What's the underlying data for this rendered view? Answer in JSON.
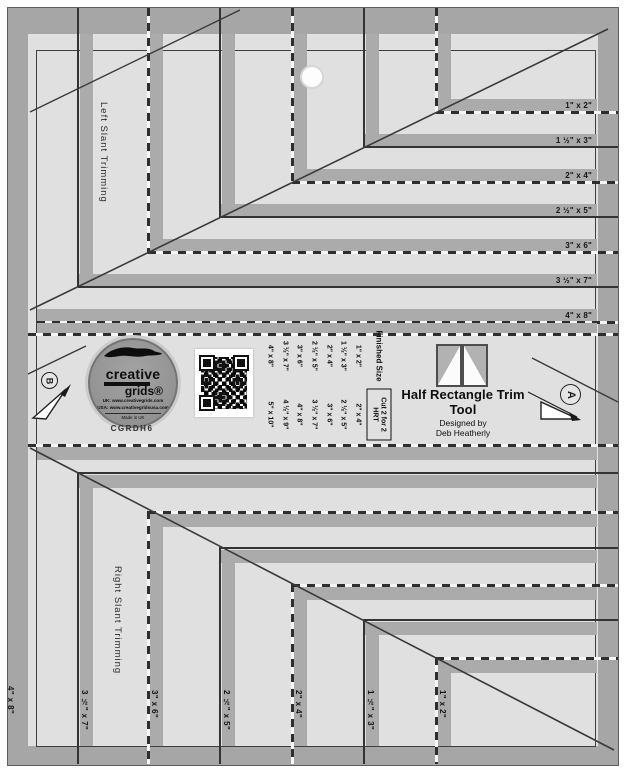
{
  "product": {
    "title": "Half Rectangle Trim Tool",
    "designed_by_label": "Designed by",
    "designer": "Deb Heatherly",
    "item_code": "CGRDH6"
  },
  "logo": {
    "brand_top": "creative",
    "brand_bottom": "grids®",
    "website_uk": "UK:  www.creativegrids.com",
    "website_usa": "USA:  www.creativegridsusa.com",
    "made_in": "Made in UK"
  },
  "markings": {
    "left_slant": "Left Slant Trimming",
    "right_slant": "Right Slant Trimming",
    "marker_a": "A",
    "marker_b": "B",
    "right_edge_sizes": [
      "1\" x 2\"",
      "1 ½\" x 3\"",
      "2\" x 4\"",
      "2 ½\" x 5\"",
      "3\" x 6\"",
      "3 ½\" x 7\"",
      "4\" x 8\""
    ],
    "bottom_edge_sizes": [
      "4\" x 8\"",
      "3 ½\" x 7\"",
      "3\" x 6\"",
      "2 ½\" x 5\"",
      "2\" x 4\"",
      "1 ½\" x 3\"",
      "1\" x 2\""
    ]
  },
  "size_table": {
    "finished_header": "Finished Size",
    "cut_header": "Cut 2 for 2 HRT",
    "rows": [
      {
        "finished": "1\" x 2\"",
        "cut": "2\" x 4\""
      },
      {
        "finished": "1 ½\" x 3\"",
        "cut": "2 ½\" x 5\""
      },
      {
        "finished": "2\" x 4\"",
        "cut": "3\" x 6\""
      },
      {
        "finished": "2 ½\" x 5\"",
        "cut": "3 ½\" x 7\""
      },
      {
        "finished": "3\" x 6\"",
        "cut": "4\" x 8\""
      },
      {
        "finished": "3 ½\" x 7\"",
        "cut": "4 ½\" x 9\""
      },
      {
        "finished": "4\" x 8\"",
        "cut": "5\" x 10\""
      }
    ]
  },
  "colors": {
    "body": "#e0e0e0",
    "stripe": "#ababab",
    "frame": "#a6a6a6",
    "ink": "#2e2e2e"
  }
}
